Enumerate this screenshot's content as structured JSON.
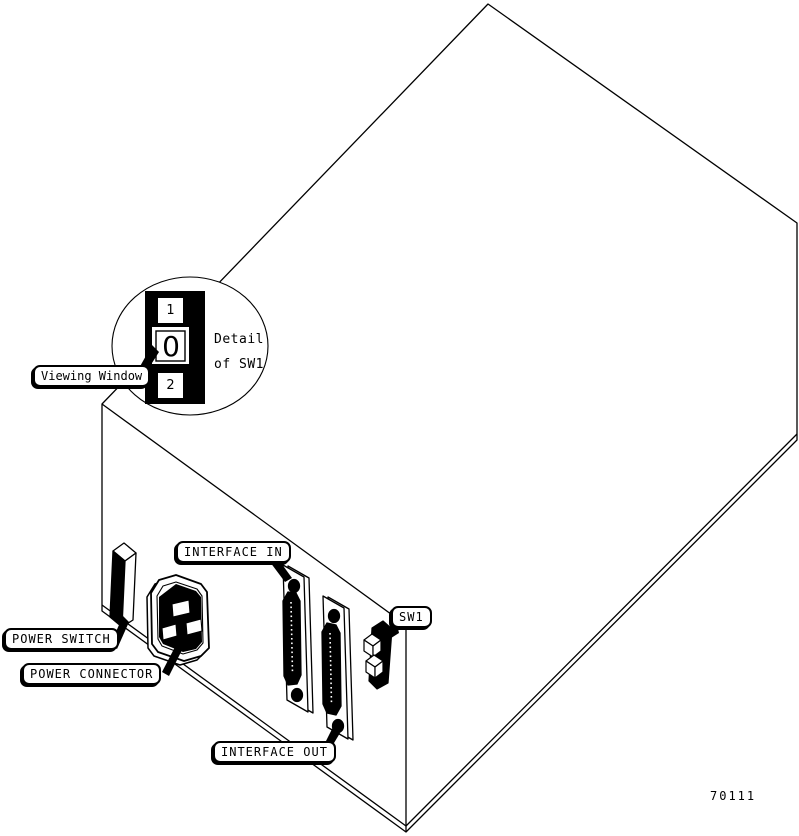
{
  "figure": {
    "number": "70111",
    "detail": {
      "line1": "Detail",
      "line2": "of SW1"
    },
    "switch_positions": {
      "top": "1",
      "middle": "0",
      "bottom": "2"
    },
    "labels": {
      "viewing_window": "Viewing Window",
      "power_switch": "POWER SWITCH",
      "power_connector": "POWER CONNECTOR",
      "interface_in": "INTERFACE IN",
      "interface_out": "INTERFACE OUT",
      "sw1": "SW1"
    },
    "colors": {
      "line": "#000000",
      "background": "#ffffff"
    }
  }
}
